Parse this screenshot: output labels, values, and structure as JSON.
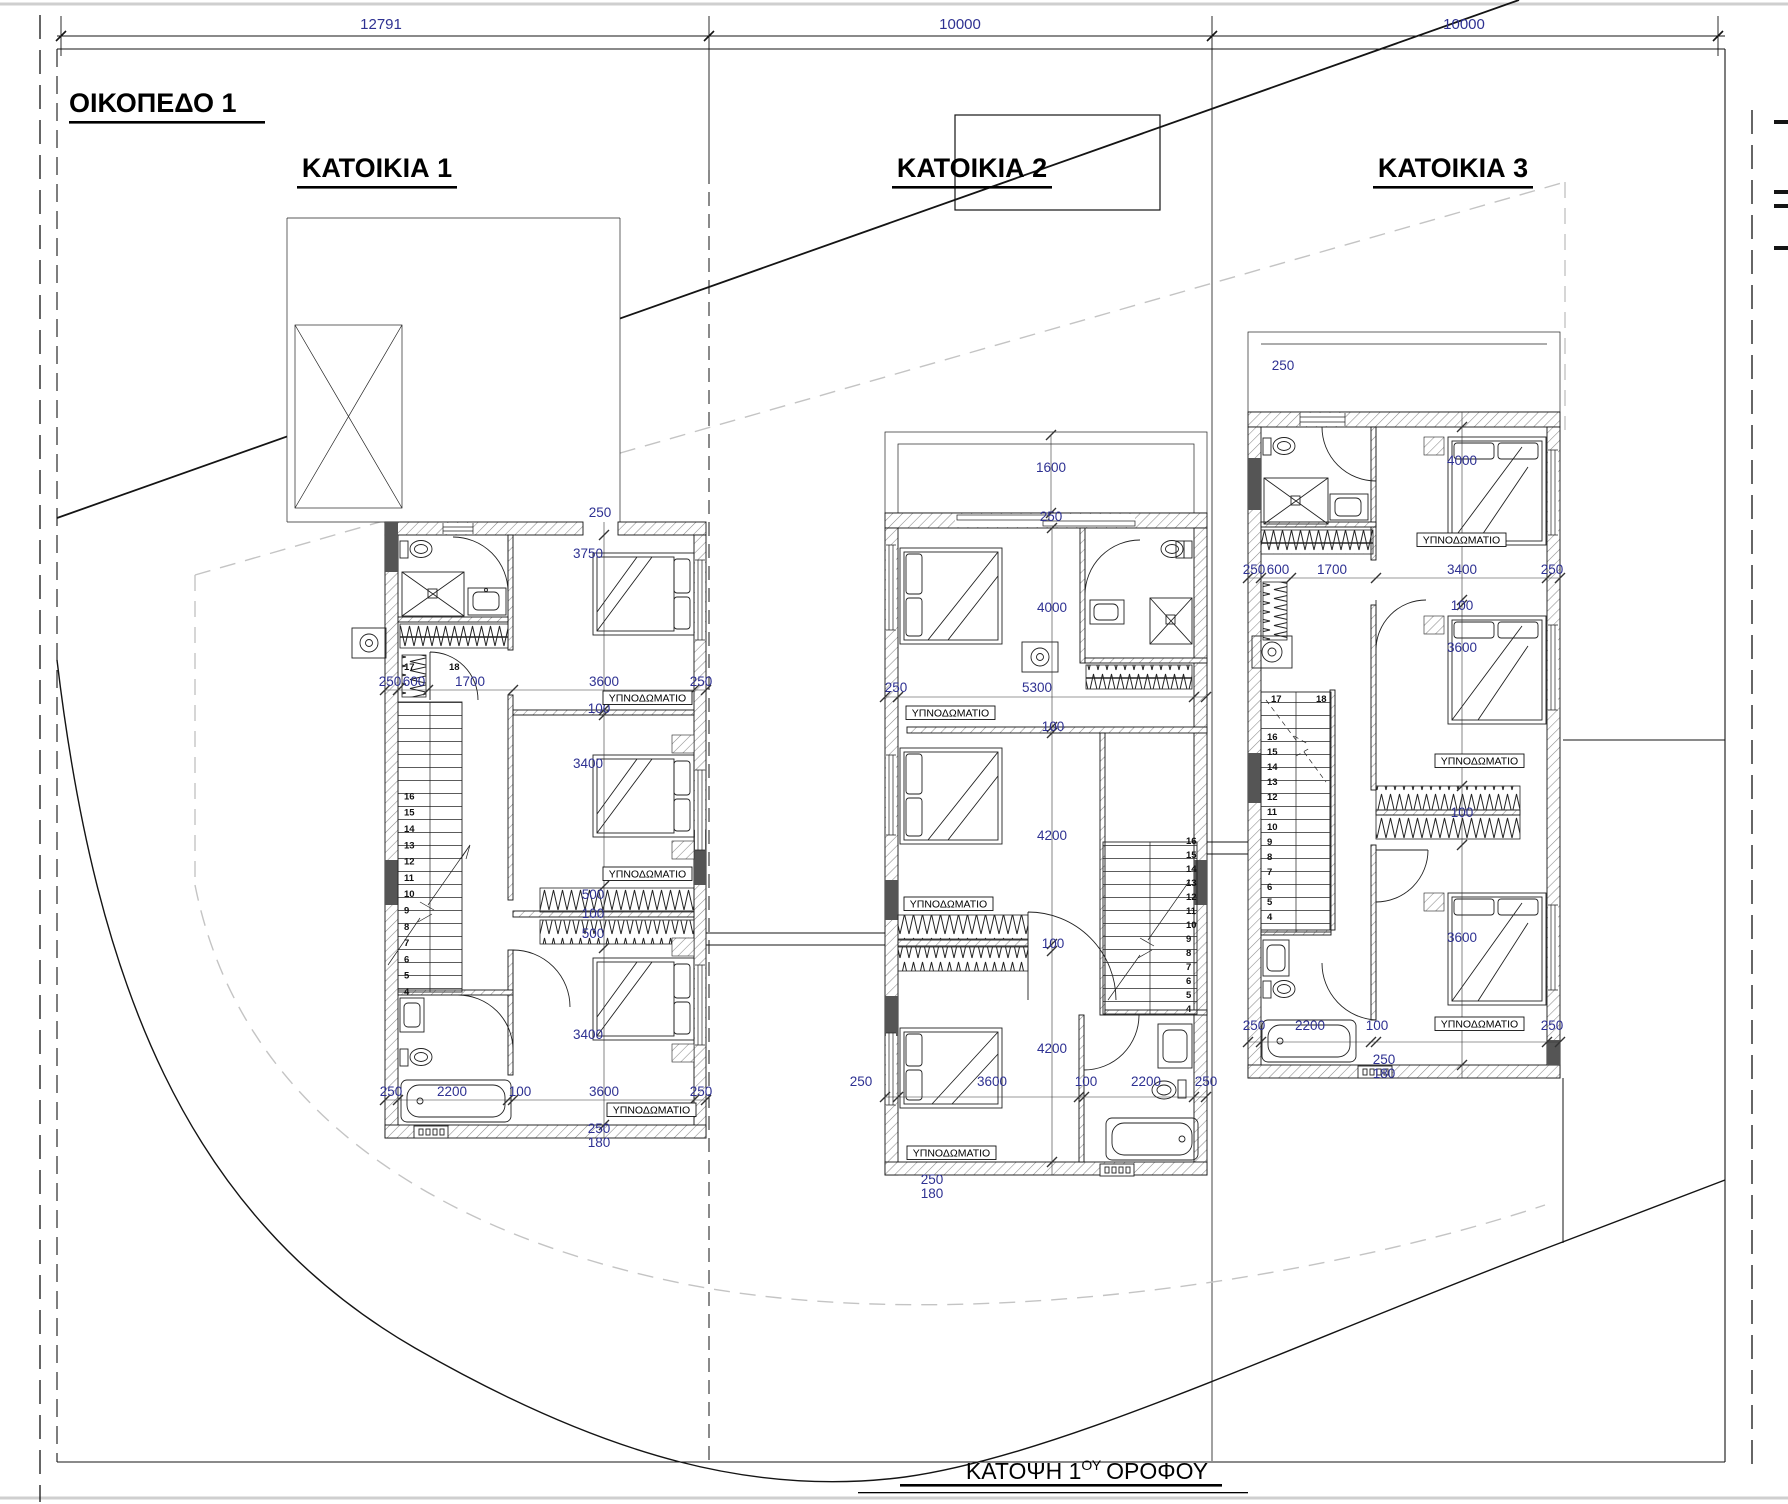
{
  "drawing": {
    "plot_title": "ΟΙΚΟΠΕΔΟ 1",
    "caption": {
      "prefix": "ΚΑΤΟΨΗ 1",
      "sup": "ΟΥ",
      "suffix": "ΟΡΟΦΟΥ"
    },
    "houses": [
      {
        "title": "ΚΑΤΟΙΚΙΑ 1"
      },
      {
        "title": "ΚΑΤΟΙΚΙΑ 2"
      },
      {
        "title": "ΚΑΤΟΙΚΙΑ 3"
      }
    ],
    "room_label": "ΥΠΝΟΔΩΜΑΤΙΟ",
    "colors": {
      "dimension_text": "#2e3192",
      "line": "#141414",
      "hatch": "#8a8a8a",
      "setback_dash": "#c4c4c4"
    },
    "dimension_labels": [
      {
        "t": "12791",
        "x": 381,
        "y": 29,
        "fs": 15
      },
      {
        "t": "10000",
        "x": 960,
        "y": 29,
        "fs": 15
      },
      {
        "t": "10000",
        "x": 1464,
        "y": 29,
        "fs": 15
      },
      {
        "t": "250",
        "x": 390,
        "y": 686
      },
      {
        "t": "600",
        "x": 414,
        "y": 686
      },
      {
        "t": "1700",
        "x": 470,
        "y": 686
      },
      {
        "t": "3600",
        "x": 604,
        "y": 686
      },
      {
        "t": "250",
        "x": 701,
        "y": 686
      },
      {
        "t": "250",
        "x": 600,
        "y": 517
      },
      {
        "t": "3750",
        "x": 588,
        "y": 558
      },
      {
        "t": "100",
        "x": 599,
        "y": 713
      },
      {
        "t": "3400",
        "x": 588,
        "y": 768
      },
      {
        "t": "500",
        "x": 593,
        "y": 899
      },
      {
        "t": "100",
        "x": 593,
        "y": 918
      },
      {
        "t": "500",
        "x": 593,
        "y": 938
      },
      {
        "t": "3400",
        "x": 588,
        "y": 1039
      },
      {
        "t": "250",
        "x": 391,
        "y": 1096
      },
      {
        "t": "2200",
        "x": 452,
        "y": 1096
      },
      {
        "t": "100",
        "x": 520,
        "y": 1096
      },
      {
        "t": "3600",
        "x": 604,
        "y": 1096
      },
      {
        "t": "250",
        "x": 701,
        "y": 1096
      },
      {
        "t": "250",
        "x": 599,
        "y": 1133
      },
      {
        "t": "180",
        "x": 599,
        "y": 1147
      },
      {
        "t": "17",
        "x": 404,
        "y": 670,
        "fs": 9.5
      },
      {
        "t": "18",
        "x": 449,
        "y": 670,
        "fs": 9.5
      },
      {
        "t": "1600",
        "x": 1051,
        "y": 472
      },
      {
        "t": "250",
        "x": 1051,
        "y": 521
      },
      {
        "t": "4000",
        "x": 1052,
        "y": 612
      },
      {
        "t": "250",
        "x": 896,
        "y": 692
      },
      {
        "t": "5300",
        "x": 1037,
        "y": 692
      },
      {
        "t": "100",
        "x": 1053,
        "y": 731
      },
      {
        "t": "4200",
        "x": 1052,
        "y": 840
      },
      {
        "t": "100",
        "x": 1053,
        "y": 948
      },
      {
        "t": "4200",
        "x": 1052,
        "y": 1053
      },
      {
        "t": "250",
        "x": 861,
        "y": 1086
      },
      {
        "t": "3600",
        "x": 992,
        "y": 1086
      },
      {
        "t": "100",
        "x": 1086,
        "y": 1086
      },
      {
        "t": "2200",
        "x": 1146,
        "y": 1086
      },
      {
        "t": "250",
        "x": 1206,
        "y": 1086
      },
      {
        "t": "250",
        "x": 932,
        "y": 1184
      },
      {
        "t": "180",
        "x": 932,
        "y": 1198
      },
      {
        "t": "250",
        "x": 1283,
        "y": 370
      },
      {
        "t": "4000",
        "x": 1462,
        "y": 465
      },
      {
        "t": "250",
        "x": 1254,
        "y": 574
      },
      {
        "t": "600",
        "x": 1278,
        "y": 574
      },
      {
        "t": "1700",
        "x": 1332,
        "y": 574
      },
      {
        "t": "3400",
        "x": 1462,
        "y": 574
      },
      {
        "t": "250",
        "x": 1552,
        "y": 574
      },
      {
        "t": "100",
        "x": 1462,
        "y": 610
      },
      {
        "t": "3600",
        "x": 1462,
        "y": 652
      },
      {
        "t": "100",
        "x": 1462,
        "y": 817
      },
      {
        "t": "3600",
        "x": 1462,
        "y": 942
      },
      {
        "t": "250",
        "x": 1254,
        "y": 1030
      },
      {
        "t": "2200",
        "x": 1310,
        "y": 1030
      },
      {
        "t": "100",
        "x": 1377,
        "y": 1030
      },
      {
        "t": "3400",
        "x": 1462,
        "y": 1030
      },
      {
        "t": "250",
        "x": 1552,
        "y": 1030
      },
      {
        "t": "250",
        "x": 1384,
        "y": 1064
      },
      {
        "t": "180",
        "x": 1384,
        "y": 1078
      },
      {
        "t": "17",
        "x": 1271,
        "y": 702,
        "fs": 9.5
      },
      {
        "t": "18",
        "x": 1316,
        "y": 702,
        "fs": 9.5
      }
    ],
    "room_label_boxes": [
      {
        "x": 603,
        "y": 691
      },
      {
        "x": 603,
        "y": 867
      },
      {
        "x": 607,
        "y": 1103
      },
      {
        "x": 906,
        "y": 706
      },
      {
        "x": 904,
        "y": 897
      },
      {
        "x": 907,
        "y": 1146
      },
      {
        "x": 1417,
        "y": 533
      },
      {
        "x": 1435,
        "y": 754
      },
      {
        "x": 1435,
        "y": 1017
      }
    ],
    "stairs": [
      {
        "x": 404,
        "y0": 995,
        "dy": 16.3,
        "numbers": [
          "4",
          "5",
          "6",
          "7",
          "8",
          "9",
          "10",
          "11",
          "12",
          "13",
          "14",
          "15",
          "16"
        ]
      },
      {
        "x": 1186,
        "y0": 1012,
        "dy": 14,
        "numbers": [
          "4",
          "5",
          "6",
          "7",
          "8",
          "9",
          "10",
          "11",
          "12",
          "13",
          "14",
          "15",
          "16"
        ]
      },
      {
        "x": 1267,
        "y0": 920,
        "dy": 15,
        "numbers": [
          "4",
          "5",
          "6",
          "7",
          "8",
          "9",
          "10",
          "11",
          "12",
          "13",
          "14",
          "15",
          "16"
        ]
      }
    ]
  }
}
